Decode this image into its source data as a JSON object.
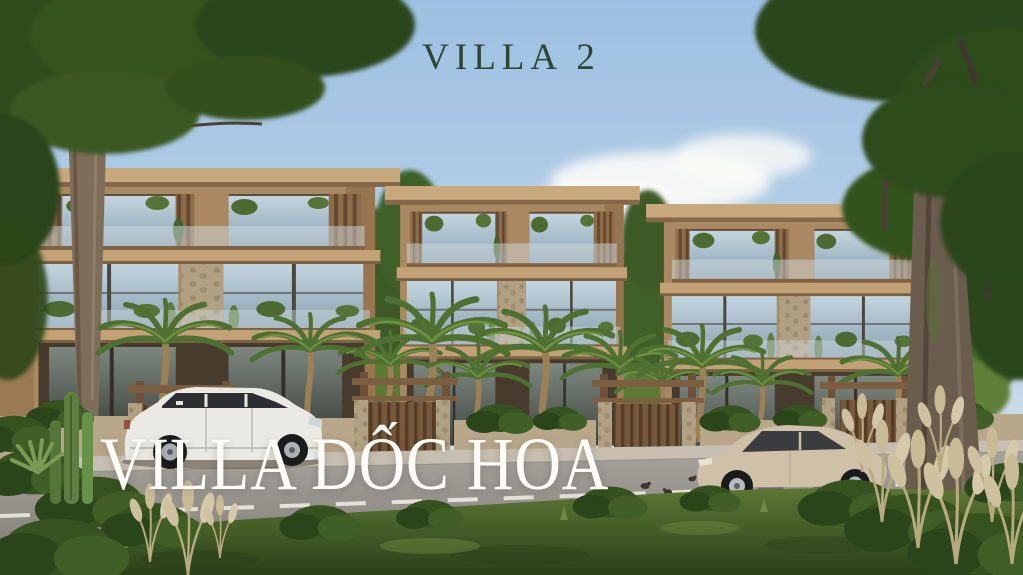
{
  "slide": {
    "heading": "VILLA 2",
    "project_title": "VILLA DỐC HOA"
  },
  "scene": {
    "illustration": "street-view render of three modern three-storey villas with timber-slat facades, stone columns, balcony plants and palm trees",
    "vehicles": [
      "white-suv-facing-right",
      "beige-sedan-facing-left"
    ]
  },
  "colors": {
    "heading_green": "#2b4733",
    "title_white": "#fcfbf6",
    "sky_blue": "#9dc0e2",
    "building_tan": "#aa8962",
    "roof_tan": "#c8a97e",
    "wood_brown": "#77593c",
    "stone_beige": "#b2a082",
    "foliage_green": "#2e4c1f",
    "grass_green": "#4c6428",
    "road_gray": "#9a9690",
    "suv_white": "#ebe9e4",
    "sedan_beige": "#cfc0a8"
  }
}
